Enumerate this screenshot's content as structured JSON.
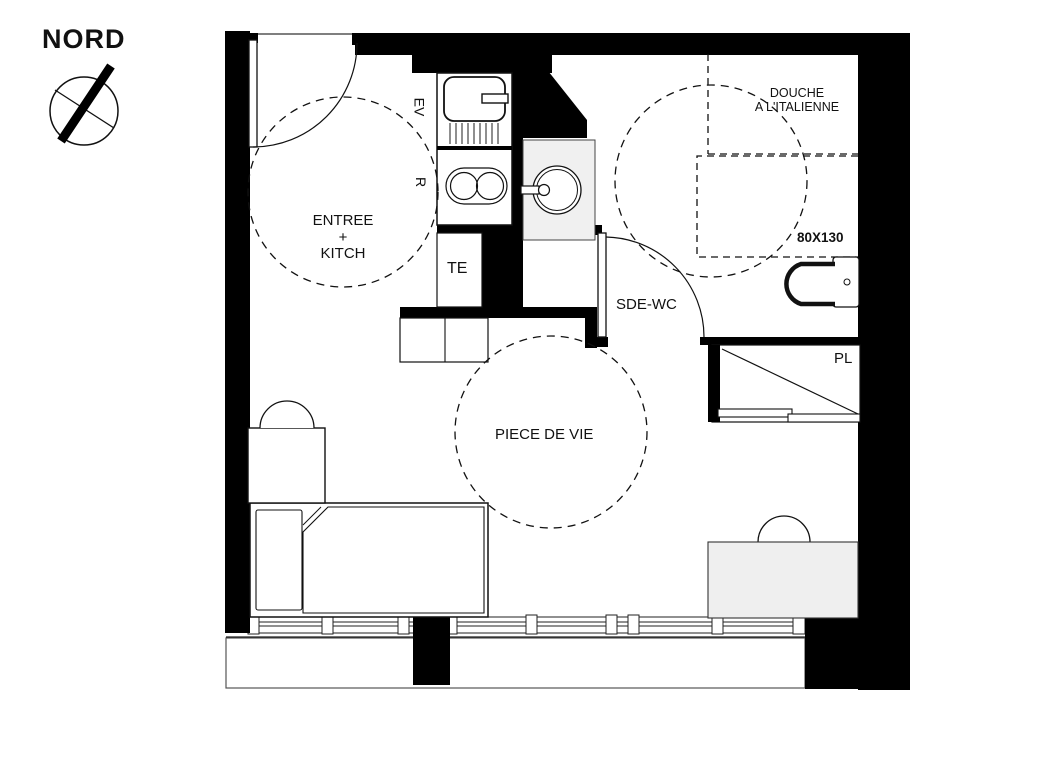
{
  "title": "Plan studio",
  "colors": {
    "ink": "#111111",
    "wall": "#000000",
    "fixture_fill": "#f0f0f0",
    "background": "#ffffff"
  },
  "compass": {
    "label": "NORD"
  },
  "rooms": {
    "entry_kitchen": {
      "line1": "ENTREE",
      "line2": "+",
      "line3": "KITCH"
    },
    "bathroom": {
      "label": "SDE-WC"
    },
    "living": {
      "label": "PIECE DE VIE"
    },
    "closet": {
      "label": "PL"
    }
  },
  "fixtures": {
    "sink_label": "EV",
    "cooktop_label": "R",
    "electrical_label": "TE",
    "shower": {
      "line1": "DOUCHE",
      "line2": "A L'ITALIENNE",
      "size": "80X130"
    }
  }
}
